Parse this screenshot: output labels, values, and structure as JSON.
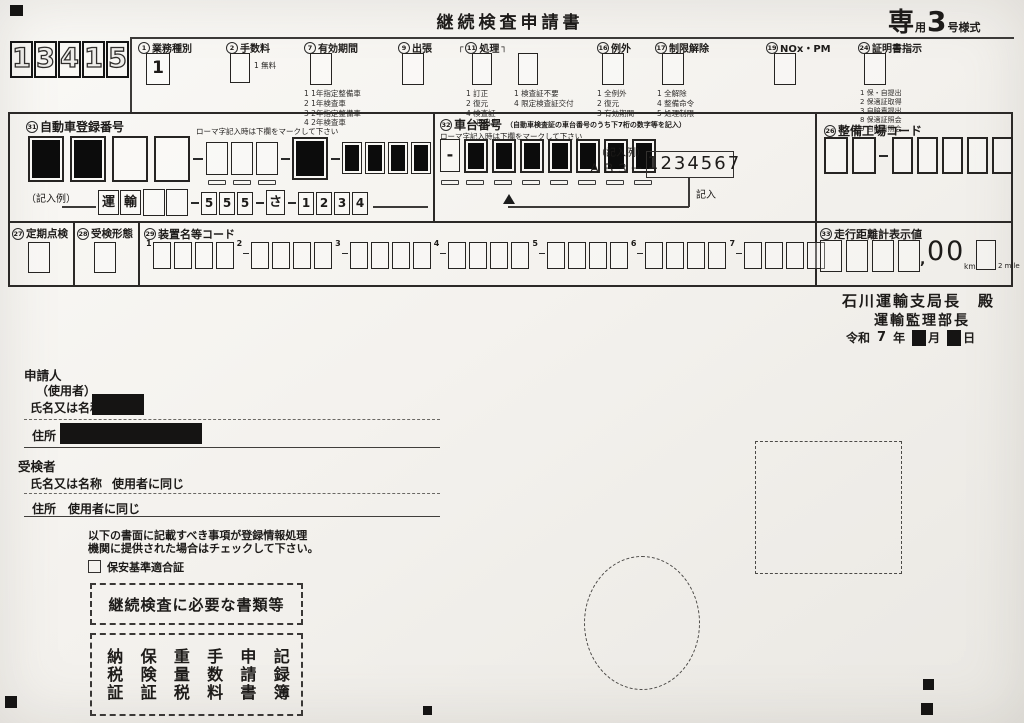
{
  "form": {
    "title": "継続検査申請書",
    "style_mark": {
      "c1": "専",
      "c2": "用",
      "c3": "3",
      "c4": "号様式"
    },
    "stamp_digits": [
      "1",
      "3",
      "4",
      "1",
      "5"
    ]
  },
  "top_fields": {
    "gyomu": {
      "num": "1",
      "text": "業務種別",
      "value": "1"
    },
    "tesuryo": {
      "num": "2",
      "text": "手数料",
      "note": "1 無料"
    },
    "yuko": {
      "num": "7",
      "text": "有効期間",
      "options": [
        "1 1年指定整備車",
        "2 1年検査車",
        "3 2年指定整備車",
        "4 2年検査車"
      ]
    },
    "shutcho": {
      "num": "9",
      "text": "出張"
    },
    "shori": {
      "num": "11",
      "text": "処理",
      "bracket_l": "┌",
      "bracket_r": "┐",
      "box1_options": [
        "1 訂正",
        "2 復元",
        "4 検査証",
        "　 再出力"
      ],
      "box2_options": [
        "1 検査証不要",
        "4 限定検査証交付"
      ]
    },
    "reigai": {
      "num": "16",
      "text": "例外",
      "options": [
        "1 全例外",
        "2 復元",
        "3 有効期間"
      ]
    },
    "seigen": {
      "num": "17",
      "text": "制限解除",
      "options": [
        "1 全解除",
        "4 整備命令",
        "5 処理制限"
      ]
    },
    "nox": {
      "num": "19",
      "text": "NOx・PM"
    },
    "shomei": {
      "num": "24",
      "text": "証明書指示",
      "options": [
        "1 保・自提出",
        "2 保適証取得",
        "3 自賠責提出",
        "8 保適証照会",
        "9 自賠責照会"
      ]
    }
  },
  "reg_number": {
    "num": "31",
    "text": "自動車登録番号",
    "roman_note": "ローマ字記入時は下欄をマークして下さい",
    "big_filled": [
      1,
      1,
      0,
      0
    ],
    "mid_filled": 1,
    "last_filled": [
      1,
      1,
      1,
      1
    ],
    "example_label": "（記入例）",
    "example": {
      "kanji": [
        "運",
        "輸"
      ],
      "digits1": [
        "5",
        "5",
        "5"
      ],
      "kana": "さ",
      "digits2": [
        "1",
        "2",
        "3",
        "4"
      ]
    }
  },
  "chassis": {
    "num": "32",
    "text": "車台番号",
    "sub_note": "（自動車検査証の車台番号のうち下7桁の数字等を記入）",
    "roman_note": "ローマ字記入時は下欄をマークして下さい",
    "dash_box": "-",
    "filled": [
      1,
      1,
      1,
      1,
      1,
      1,
      1
    ],
    "example_label": "（記入例）",
    "example_prefix": "ＡＢ３－",
    "example_value": "1234567",
    "arrow_label": "記入"
  },
  "factory": {
    "num": "26",
    "text": "整備工場コード"
  },
  "teiki": {
    "num": "27",
    "text": "定期点検"
  },
  "juken": {
    "num": "28",
    "text": "受検形態"
  },
  "devices": {
    "num": "29",
    "text": "装置名等コード",
    "groups": [
      "1",
      "2",
      "3",
      "4",
      "5",
      "6",
      "7"
    ]
  },
  "odometer": {
    "num": "33",
    "text": "走行距離計表示値",
    "comma": ",",
    "zeros": "00",
    "unit_km": "km",
    "unit_mile": "2 mile"
  },
  "addressee": {
    "line1": "石川運輸支局長　殿",
    "line2": "運輸監理部長",
    "era": "令和",
    "year": "7",
    "year_unit": "年",
    "month_unit": "月",
    "day_unit": "日"
  },
  "applicant": {
    "title": "申請人",
    "subtitle": "（使用者）",
    "name_label": "氏名又は名称",
    "addr_label": "住所"
  },
  "examinee": {
    "title": "受検者",
    "name_label": "氏名又は名称",
    "name_value": "使用者に同じ",
    "addr_label": "住所",
    "addr_value": "使用者に同じ"
  },
  "notice": {
    "line1": "以下の書面に記載すべき事項が登録情報処理",
    "line2": "機関に提供された場合はチェックして下さい。",
    "checkbox_label": "保安基準適合証"
  },
  "docs_title": "継続検査に必要な書類等",
  "docs_items": [
    "納税証",
    "保険証",
    "重量税",
    "手数料",
    "申請書",
    "記録簿"
  ]
}
